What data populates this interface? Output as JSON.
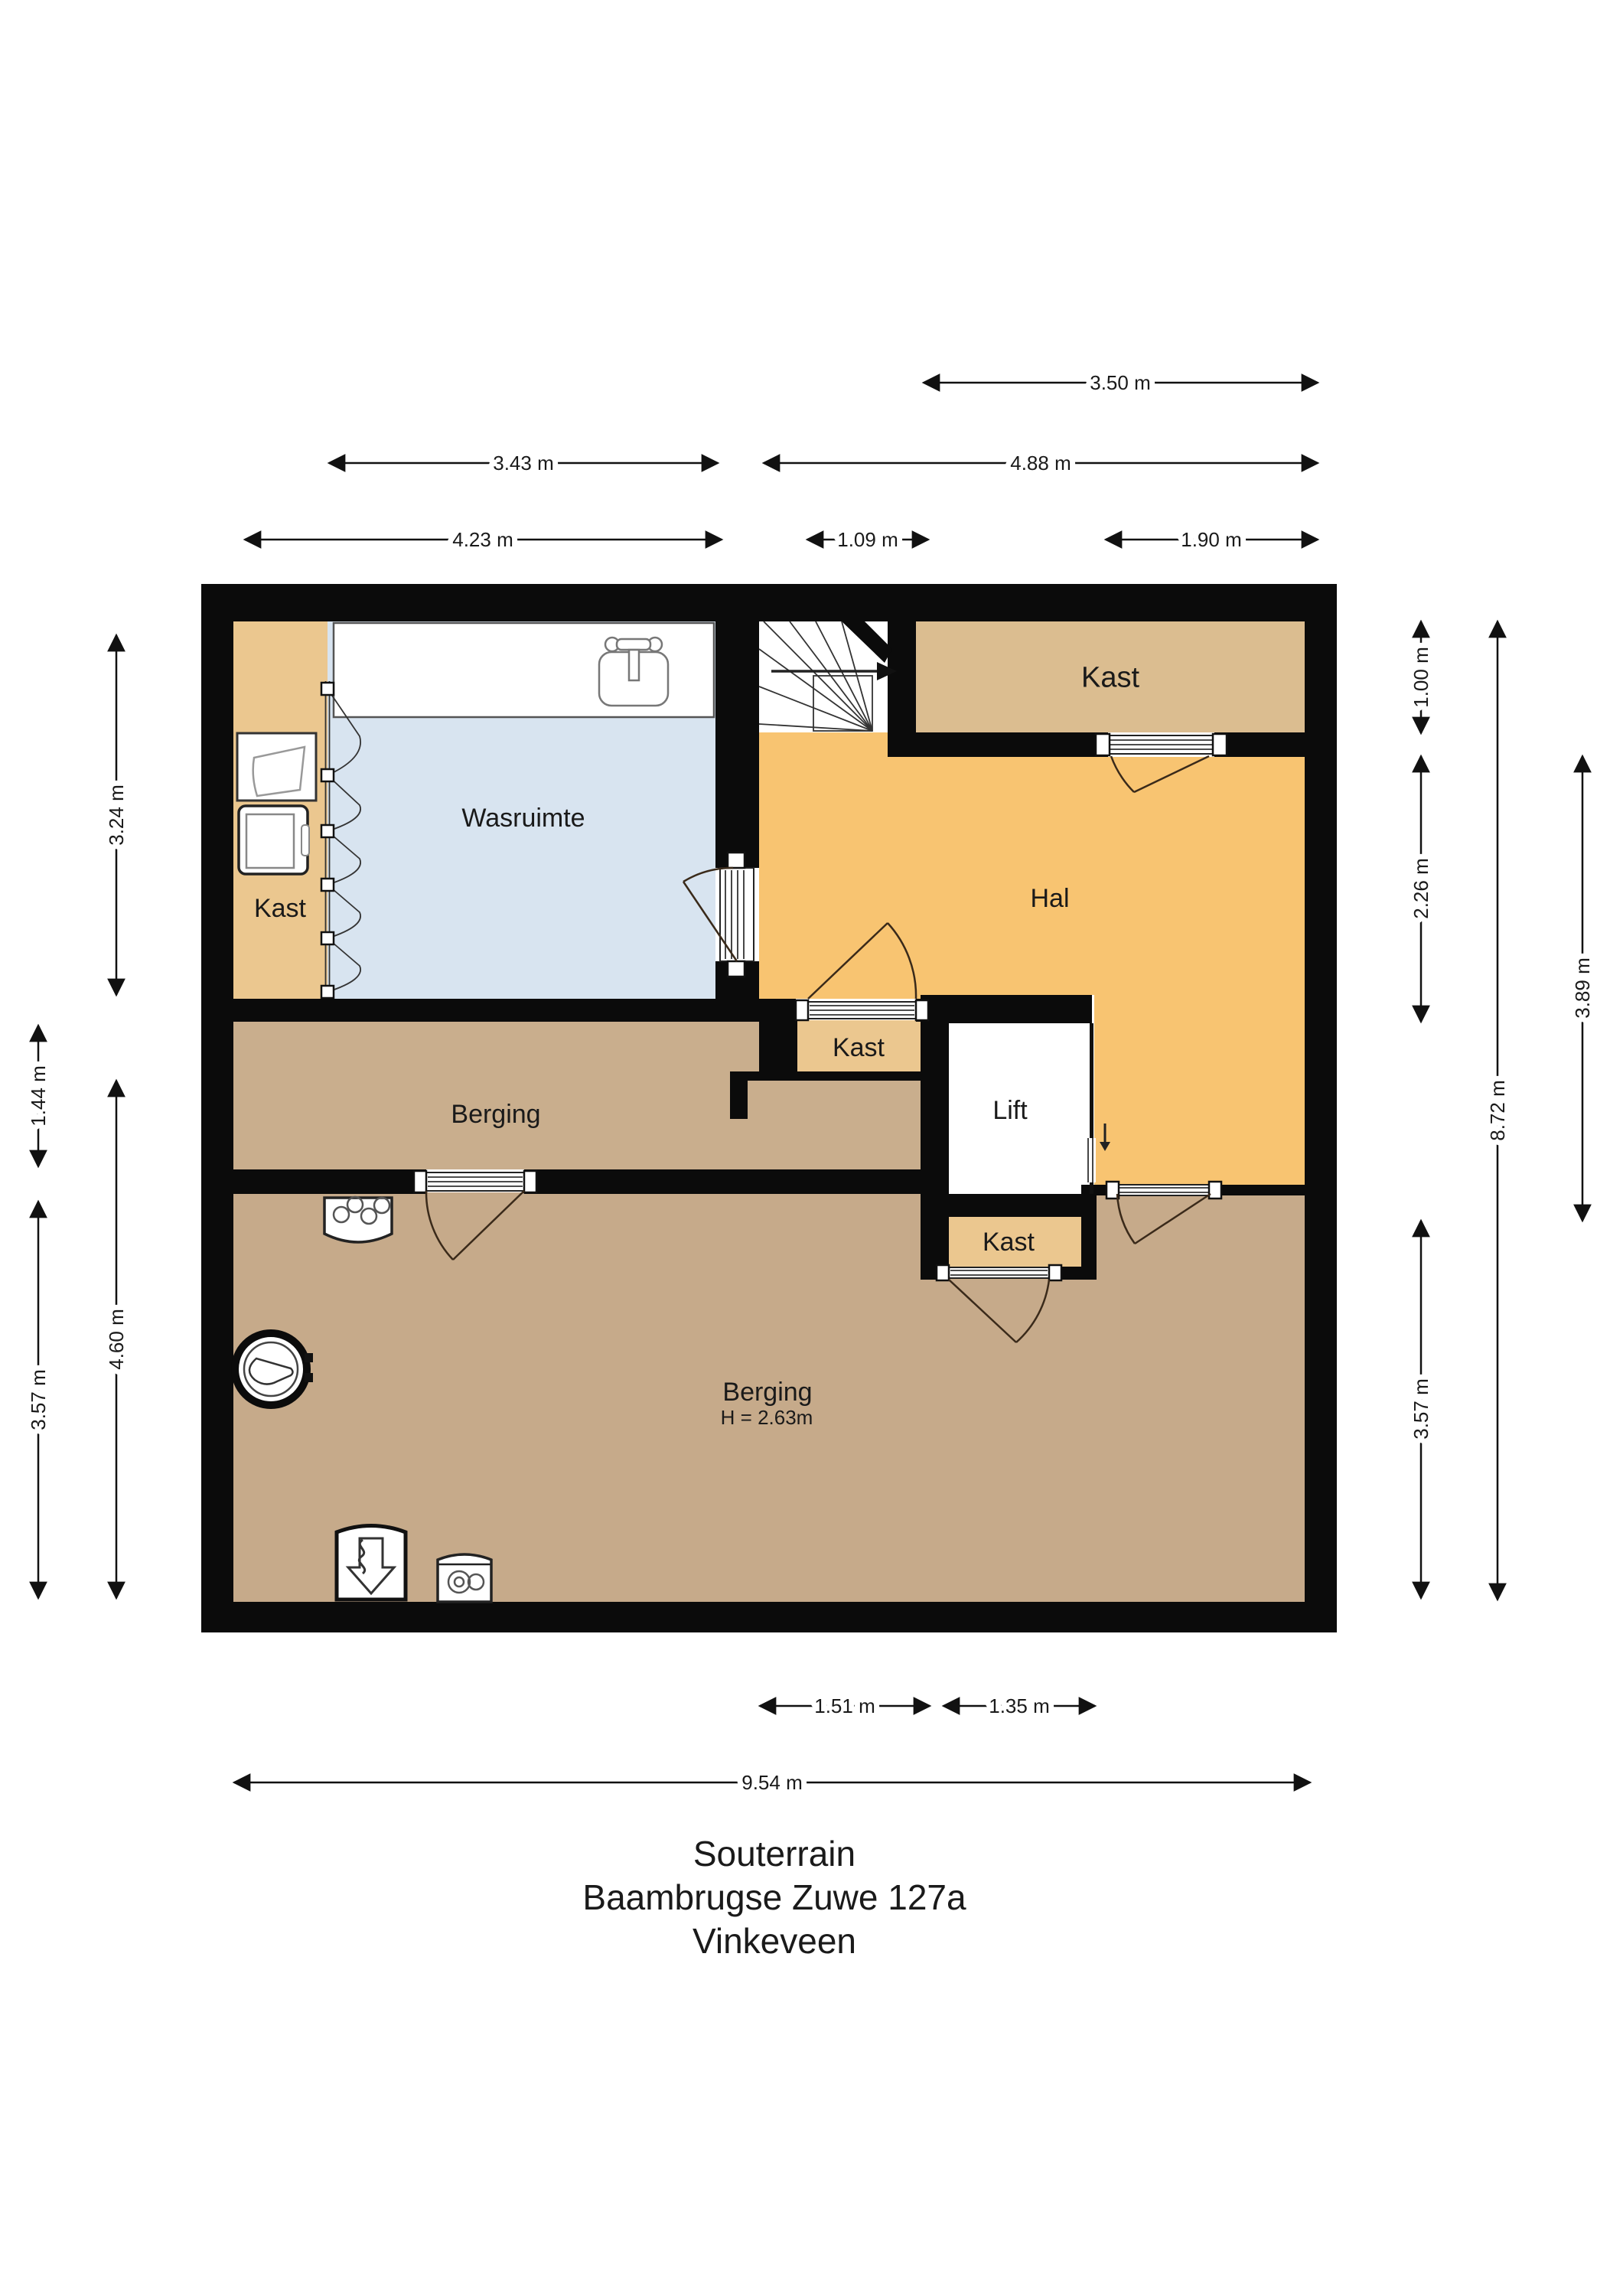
{
  "title": {
    "floor": "Souterrain",
    "address": "Baambrugse Zuwe 127a",
    "city": "Vinkeveen"
  },
  "rooms": {
    "wasruimte": "Wasruimte",
    "hal": "Hal",
    "lift": "Lift",
    "kast": "Kast",
    "berging": "Berging",
    "berging_height": "H = 2.63m"
  },
  "dims": {
    "top": [
      "3.50 m",
      "3.43 m",
      "4.88 m",
      "4.23 m",
      "1.09 m",
      "1.90 m"
    ],
    "left": [
      "3.24 m",
      "4.60 m",
      "1.44 m",
      "3.57 m"
    ],
    "right": [
      "1.00 m",
      "2.26 m",
      "3.57 m",
      "8.72 m",
      "3.89 m"
    ],
    "bottom": [
      "1.51 m",
      "1.35 m",
      "9.54 m"
    ]
  },
  "icons": {
    "stairs": "stairs-with-direction-arrow",
    "lift_arrow": "lift-down-arrow",
    "sink": "sink-icon",
    "laundry_tub": "laundry-tub-icon",
    "washer": "washing-machine-icon",
    "stove": "cooktop-icon",
    "boiler": "boiler-icon",
    "ventilation": "mechanical-ventilation-icon",
    "vessel": "expansion-vessel-icon"
  },
  "colors": {
    "wall": "#0B0B0B",
    "hal": "#F8C471",
    "kast": "#EBC78F",
    "kast_dark": "#DBBD90",
    "wasruimte": "#D8E4F0",
    "berging_upper": "#C9AE8D",
    "berging_lower": "#C6AA8A",
    "stairs": "#FFFFFF"
  }
}
